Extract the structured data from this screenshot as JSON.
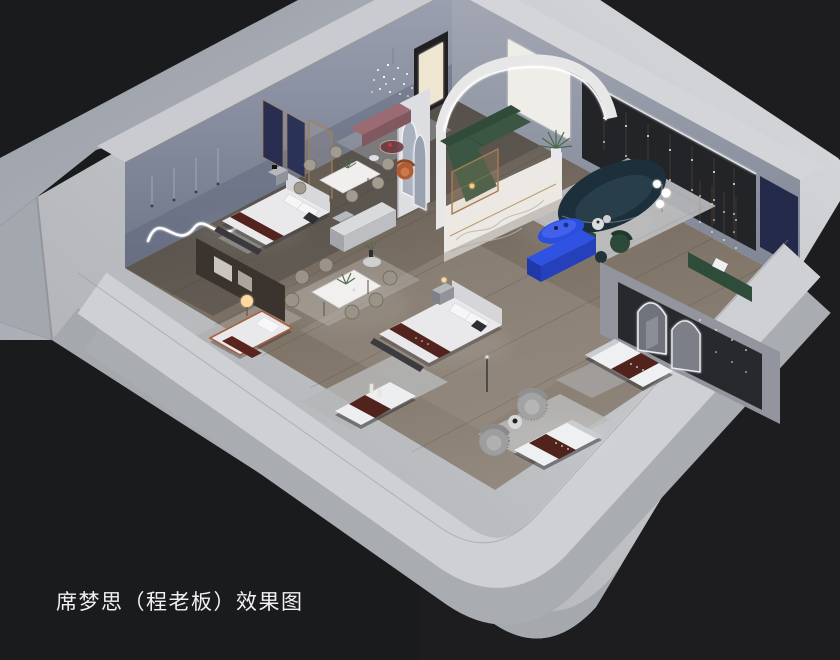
{
  "caption": {
    "text": "席梦思（程老板）效果图"
  },
  "scene": {
    "type": "interior-3d-render",
    "subject": "isometric cutaway rendering of a Simmons mattress showroom",
    "background_color": "#1a1b1d",
    "palette": {
      "outer_walls": "#c6c8cc",
      "platform": "#a9adb4",
      "interior_walls": "#8e94a4",
      "wood_floor": "#837a70",
      "rug_gray": "#b7b8ba",
      "bedding_white": "#e9e9eb",
      "brand_runner_maroon": "#55251e",
      "sofa_green": "#3b5743",
      "sofa_teal_navy": "#1d313c",
      "accent_cobalt_blue": "#2e52e0",
      "accent_wall_dark": "#242529",
      "navy_panel": "#252c4b",
      "wood_gold_trim": "#a87c50",
      "led_glow": "#ffffff"
    },
    "objects": [
      "backdrop-platform",
      "showroom-floor",
      "back-left-wall",
      "wavy-neon-light",
      "hanging-pendants",
      "entry-doorway",
      "back-right-wall",
      "backlit-art-panel",
      "accent-wall-string-lights",
      "navy-wall-panel",
      "arched-led-portal",
      "arch-niche-pillar",
      "crystal-pendant-light",
      "navy-headboard-panels",
      "bed-display-upper",
      "bed-display-center",
      "marble-partition",
      "single-bed-display",
      "dark-partition-with-art",
      "glow-sphere-lamp",
      "dining-set-upper",
      "dining-set-lower",
      "display-cabinet",
      "side-plant-table",
      "green-sectional-sofa",
      "amber-display-case",
      "curved-teal-sofa",
      "blue-oval-coffee-table",
      "blue-console",
      "green-velvet-chair",
      "mauve-bench",
      "round-glass-table",
      "orange-lounge-chair",
      "palm-plant",
      "globe-floor-lamp",
      "lounge-rug",
      "mattress-display-1",
      "mattress-display-2",
      "mattress-display-3",
      "fuzzy-swivel-chairs",
      "partition-with-arch-mirrors",
      "green-bench",
      "parapet-walls"
    ]
  }
}
